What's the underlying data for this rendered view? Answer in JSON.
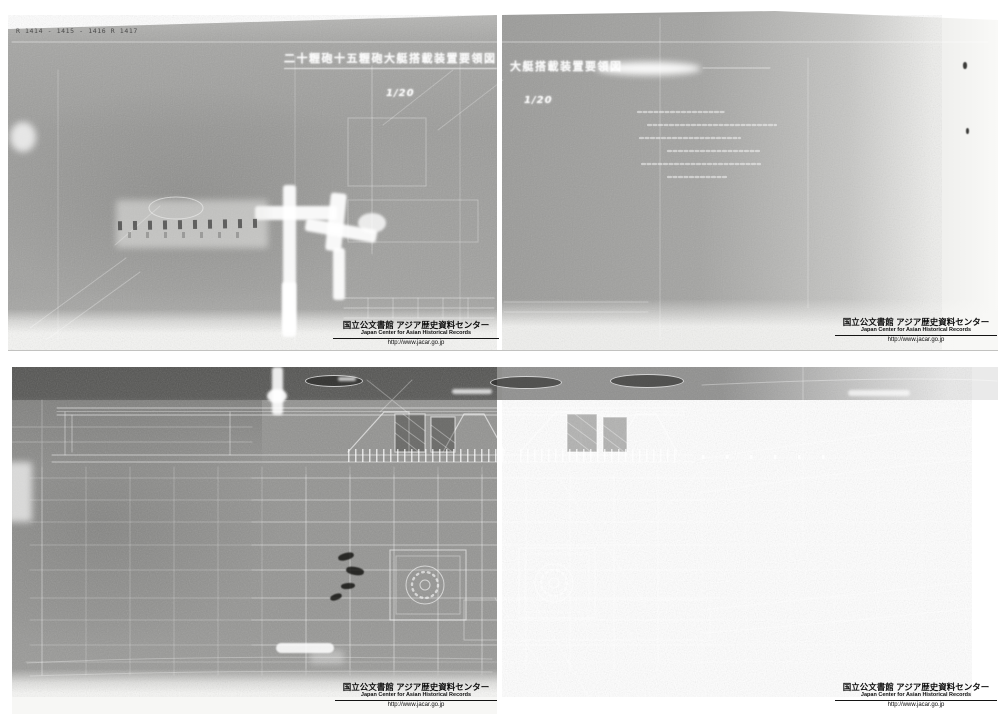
{
  "sheets": {
    "top": {
      "corner_reference": "R 1414 - 1415 - 1416 R 1417",
      "title": "二十糎砲十五糎砲大艇搭載装置要領図",
      "title_fragment_right": "大艇搭載装置要領図",
      "scale": "1/20"
    }
  },
  "watermark": {
    "jp": "国立公文書館 アジア歴史資料センター",
    "en": "Japan Center for Asian Historical Records",
    "url": "http://www.jacar.go.jp"
  },
  "colors": {
    "paper_white": "#f7f7f5",
    "scan_gray": "#9a9a98",
    "scan_dark_band": "#5f5f5d",
    "line_ink": "#ffffff",
    "watermark_text": "#0d0d0d"
  }
}
